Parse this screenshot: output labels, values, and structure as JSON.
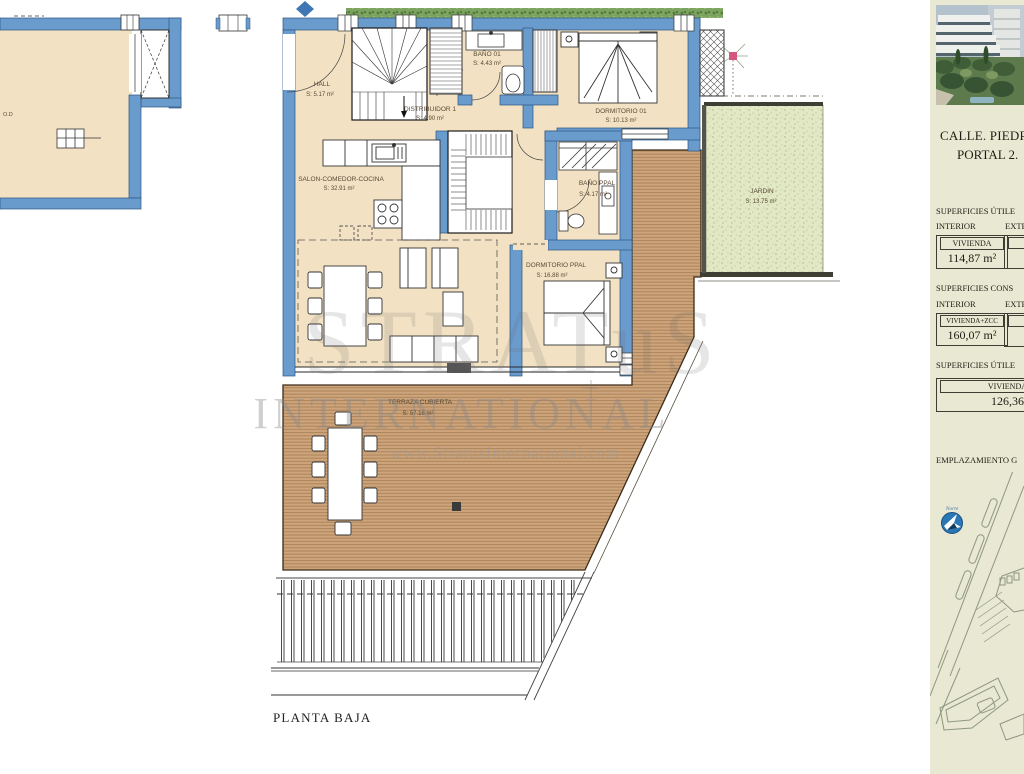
{
  "plan": {
    "footer_title": "PLANTA BAJA",
    "adjacent_unit_label": "O.D",
    "rooms": {
      "hall": {
        "name": "HALL",
        "area": "S:  5.17  m²"
      },
      "distribuidor": {
        "name": "DISTRIBUIDOR 1",
        "area": "S:  4.90  m²"
      },
      "bano01": {
        "name": "BAÑO 01",
        "area": "S:  4.43  m²"
      },
      "dormitorio01": {
        "name": "DORMITORIO 01",
        "area": "S: 10.13  m²"
      },
      "salon": {
        "name": "SALON-COMEDOR-COCINA",
        "area": "S:  32.91 m²"
      },
      "banoppal": {
        "name": "BAÑO PPAL",
        "area": "S: 4.17 m²"
      },
      "dormppal": {
        "name": "DORMITORIO PPAL",
        "area": "S:  16.88 m²"
      },
      "jardin": {
        "name": "JARDIN",
        "area": "S:  13.75 m²"
      },
      "terraza": {
        "name": "TERRAZA CUBIERTA",
        "area": "S:  57.16 m²"
      }
    }
  },
  "watermark": {
    "brand": "STRATuS",
    "line": "INTERNATIONAL",
    "url": "www.StratusInternational.com"
  },
  "panel": {
    "address1": "CALLE. PIEDR",
    "address2": "PORTAL 2.",
    "s1_title": "SUPERFICIES ÚTILE",
    "s1_col1": "INTERIOR",
    "s1_col2": "EXTE",
    "s1_row_label": "VIVIENDA",
    "s1_row_value": "114,87 m²",
    "s2_title": "SUPERFICIES CONS",
    "s2_col1": "INTERIOR",
    "s2_col2": "EXTE",
    "s2_row_label": "VIVIENDA+ZCC",
    "s2_row_value": "160,07 m²",
    "s3_title": "SUPERFICIES ÚTILE",
    "s3_row_label": "VIVIENDA",
    "s3_row_value": "126,36",
    "map_title": "EMPLAZAMIENTO G",
    "compass": "Norte"
  },
  "colors": {
    "wall_blue": "#6a9bcd",
    "floor_beige": "#f2e2c3",
    "deck_wood": "#cda47b",
    "garden_green": "#e2e8c6",
    "panel_cream": "#e9e8d2",
    "plant_pink": "#d4577e",
    "compass_blue": "#2a77b6"
  }
}
